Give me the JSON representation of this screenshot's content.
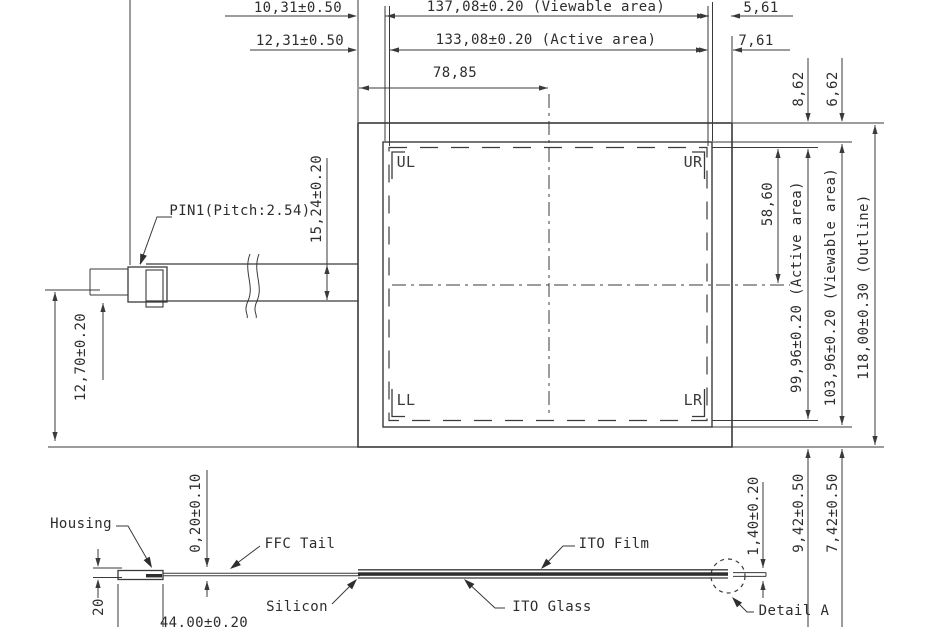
{
  "drawing": {
    "line_color": "#3a3a3a",
    "top_dims": {
      "left1": "10,31±0.50",
      "viewable": "137,08±0.20 (Viewable area)",
      "right1": "5,61",
      "left2": "12,31±0.50",
      "active": "133,08±0.20 (Active area)",
      "right2": "7,61",
      "center": "78,85"
    },
    "right_dims": {
      "offset_active_top": "8,62",
      "offset_viewable_top": "6,62",
      "center_to_top": "58,60",
      "active_v": "99,96±0.20 (Active area)",
      "viewable_v": "103,96±0.20 (Viewable area)",
      "outline_v": "118,00±0.30 (Outline)"
    },
    "left_dims": {
      "tail_width": "15,24±0.20",
      "tail_offset": "12,70±0.20"
    },
    "panel": {
      "corner_ul": "UL",
      "corner_ur": "UR",
      "corner_ll": "LL",
      "corner_lr": "LR"
    },
    "pin_label": "PIN1(Pitch:2.54)",
    "section": {
      "housing": "Housing",
      "ffc_tail": "FFC Tail",
      "silicon": "Silicon",
      "ito_film": "ITO Film",
      "ito_glass": "ITO Glass",
      "detail_a": "Detail A",
      "film_thickness": "0,20±0.10",
      "stack_thickness": "1,40±0.20",
      "drop1": "9,42±0.50",
      "drop2": "7,42±0.50",
      "tail_length": "44,00±0.20",
      "partial_dim": "20"
    }
  }
}
